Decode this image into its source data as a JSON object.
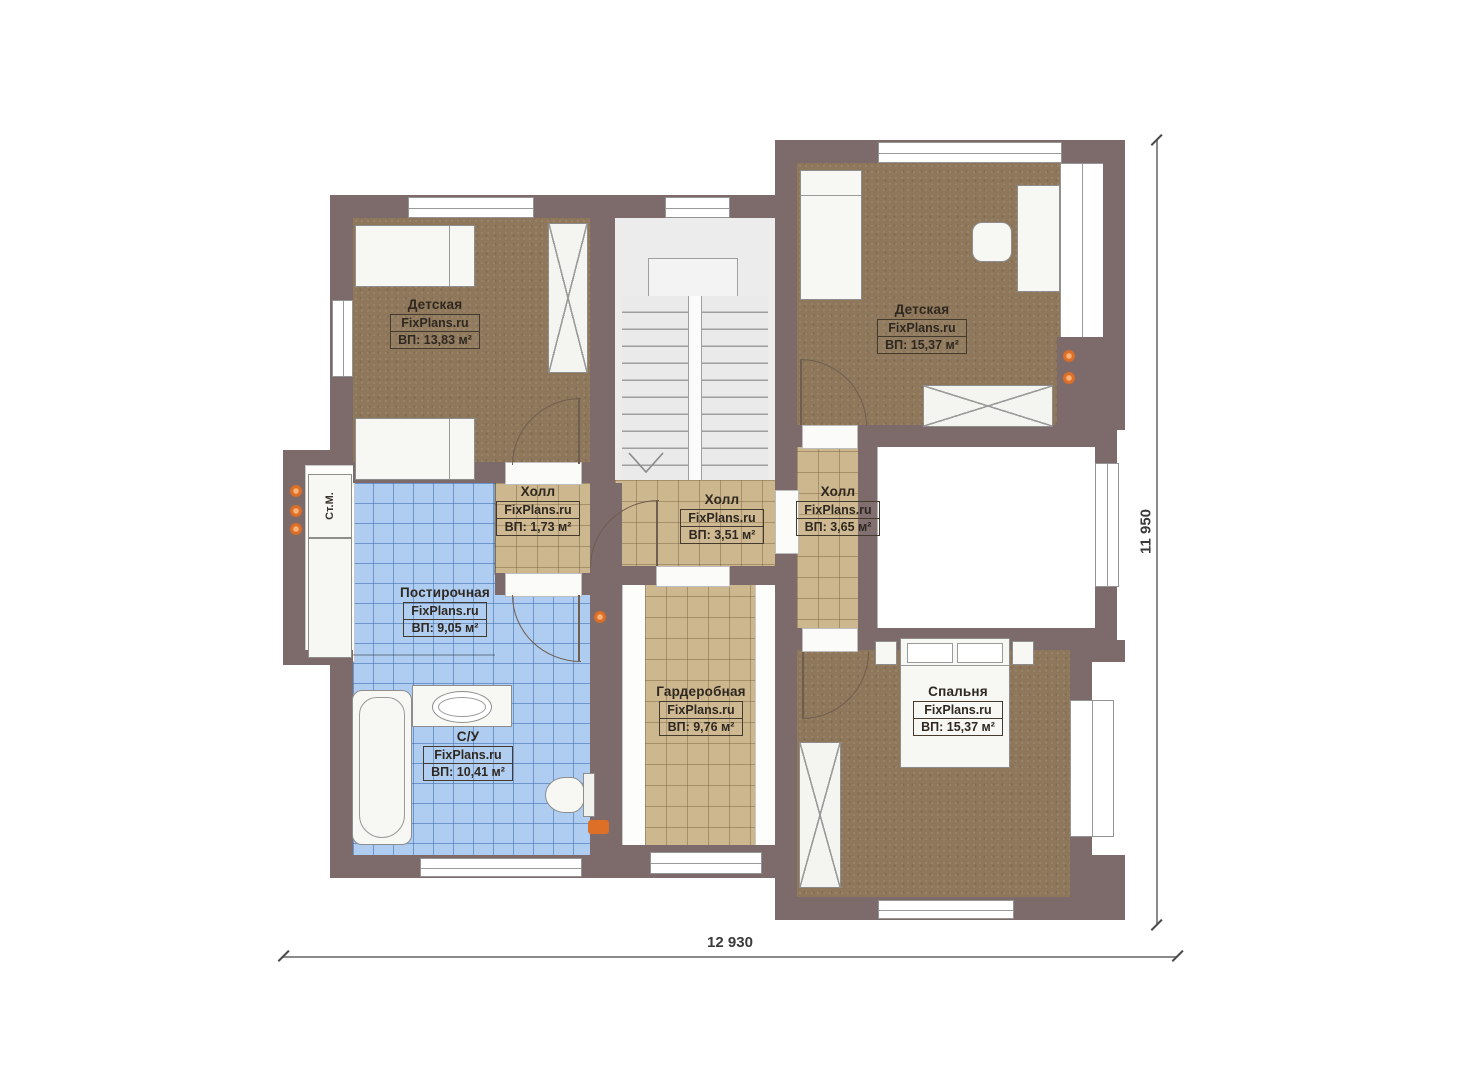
{
  "plan": {
    "rooms": [
      {
        "name": "Детская",
        "site": "FixPlans.ru",
        "area": "ВП: 13,83 м²"
      },
      {
        "name": "Детская",
        "site": "FixPlans.ru",
        "area": "ВП: 15,37 м²"
      },
      {
        "name": "Холл",
        "site": "FixPlans.ru",
        "area": "ВП: 1,73 м²"
      },
      {
        "name": "Холл",
        "site": "FixPlans.ru",
        "area": "ВП: 3,51 м²"
      },
      {
        "name": "Холл",
        "site": "FixPlans.ru",
        "area": "ВП: 3,65 м²"
      },
      {
        "name": "Постирочная",
        "site": "FixPlans.ru",
        "area": "ВП: 9,05 м²"
      },
      {
        "name": "С/У",
        "site": "FixPlans.ru",
        "area": "ВП: 10,41 м²"
      },
      {
        "name": "Гардеробная",
        "site": "FixPlans.ru",
        "area": "ВП: 9,76 м²"
      },
      {
        "name": "Спальня",
        "site": "FixPlans.ru",
        "area": "ВП: 15,37 м²"
      }
    ],
    "annotations": {
      "washing_machine": "Ст.М."
    },
    "dimensions": {
      "width_label": "12 930",
      "height_label": "11 950"
    },
    "colors": {
      "wall": "#7d6a6a",
      "carpet": "#8e775a",
      "tile_tan": "#ccb78e",
      "tile_blue": "#aecdf0",
      "stair": "#ececec",
      "accent_orange": "#dd6f26"
    }
  }
}
